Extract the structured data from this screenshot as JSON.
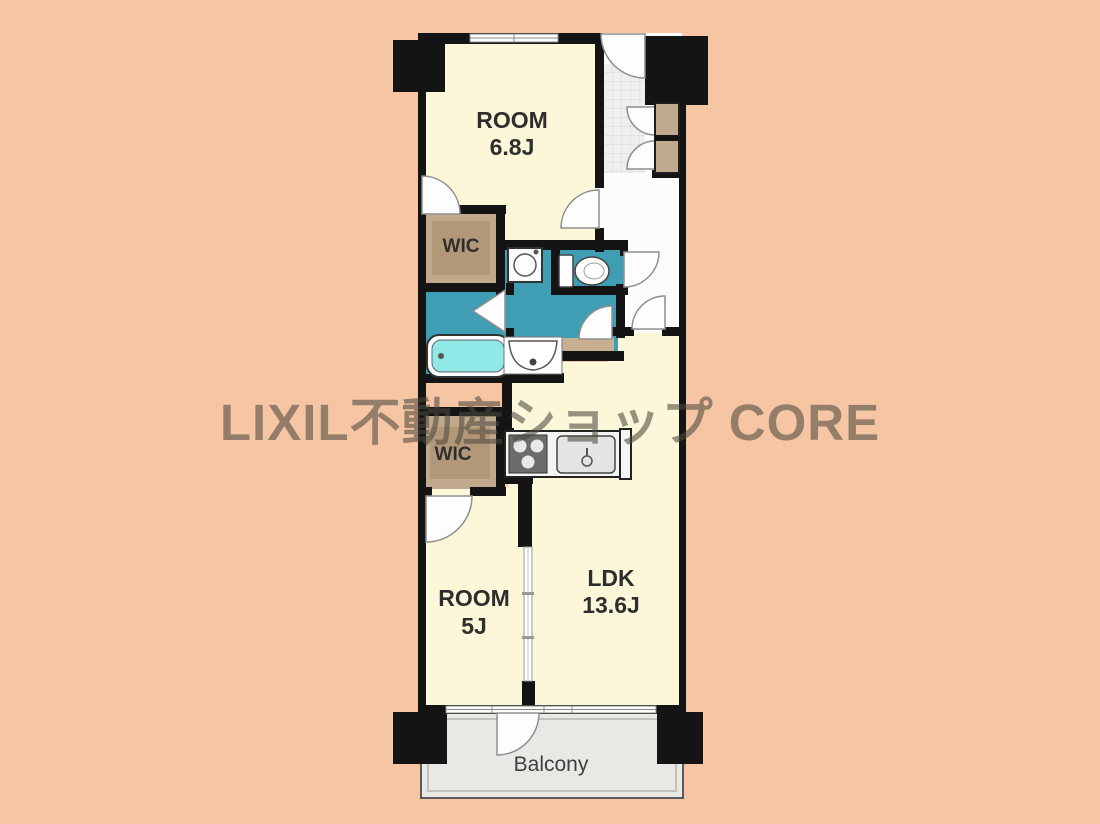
{
  "watermark": {
    "text": "LIXIL不動産ショップ CORE"
  },
  "plan": {
    "rooms": [
      {
        "name": "ROOM",
        "size": "6.8J"
      },
      {
        "name": "WIC",
        "size": ""
      },
      {
        "name": "ROOM",
        "size": "5J"
      },
      {
        "name": "WIC",
        "size": ""
      },
      {
        "name": "LDK",
        "size": "13.6J"
      },
      {
        "name": "Balcony",
        "size": ""
      }
    ],
    "colors": {
      "background": "#f6c6a4",
      "floor": "#fcf7d9",
      "wet_area": "#3f9db4",
      "bathtub_water": "#8fe9e6",
      "storage_wood": "#c0a98c",
      "storage_wood_inner": "#b29878",
      "balcony_floor": "#e9e8e4",
      "wall": "#141414"
    },
    "fixtures": [
      "entrance-door",
      "shoe-cabinet",
      "washing-machine",
      "toilet",
      "bathtub",
      "washbasin",
      "bathroom-folding-door",
      "kitchen-stove",
      "kitchen-sink",
      "sliding-partition",
      "balcony-door",
      "window"
    ]
  }
}
